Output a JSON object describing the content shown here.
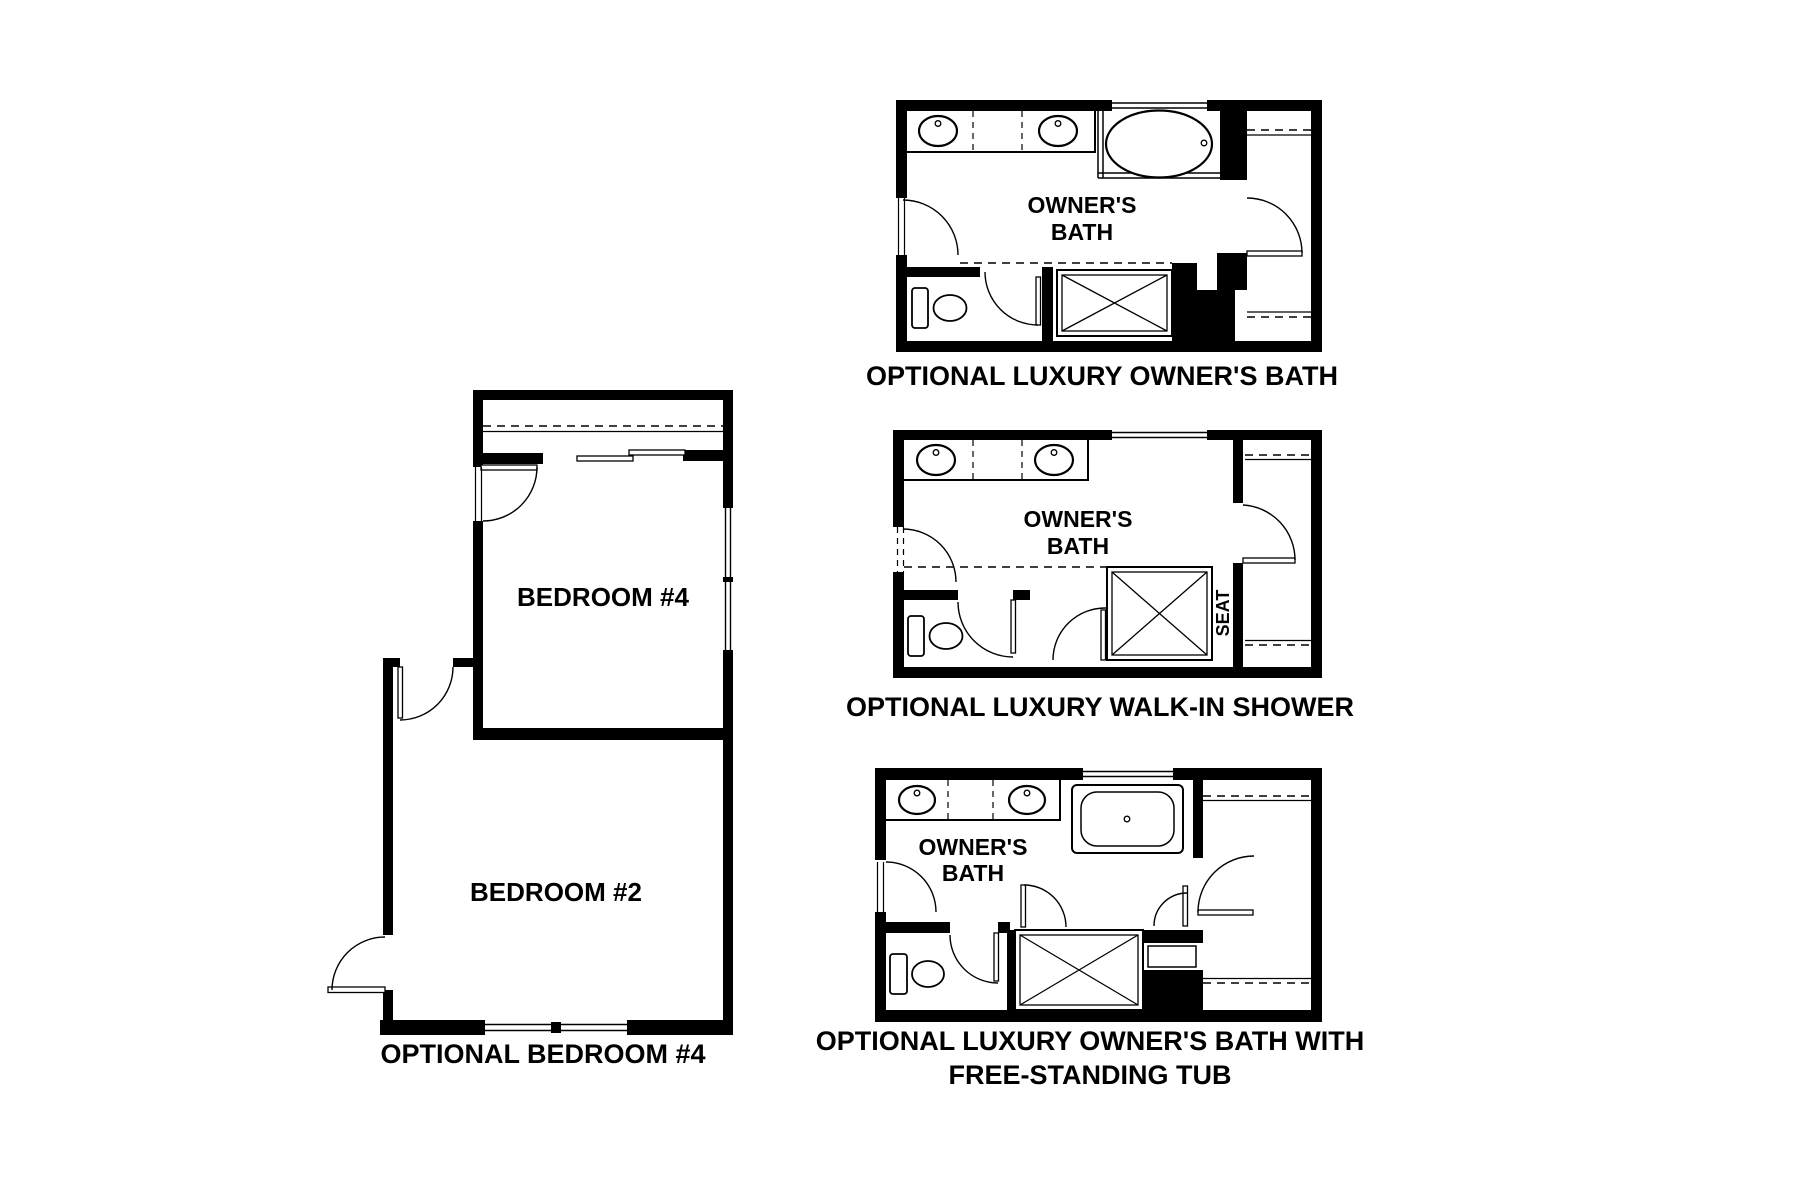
{
  "canvas": {
    "background": "#ffffff",
    "line_color": "#000000"
  },
  "bedroom_plan": {
    "caption": "OPTIONAL BEDROOM #4",
    "bedroom4_label": "BEDROOM #4",
    "bedroom2_label": "BEDROOM #2"
  },
  "owners_bath_plan": {
    "caption": "OPTIONAL LUXURY OWNER'S BATH",
    "room_label_line1": "OWNER'S",
    "room_label_line2": "BATH"
  },
  "walkin_shower_plan": {
    "caption": "OPTIONAL LUXURY WALK-IN SHOWER",
    "room_label_line1": "OWNER'S",
    "room_label_line2": "BATH",
    "seat_label": "SEAT"
  },
  "freestanding_tub_plan": {
    "caption_line1": "OPTIONAL LUXURY OWNER'S BATH WITH",
    "caption_line2": "FREE-STANDING TUB",
    "room_label_line1": "OWNER'S",
    "room_label_line2": "BATH"
  }
}
